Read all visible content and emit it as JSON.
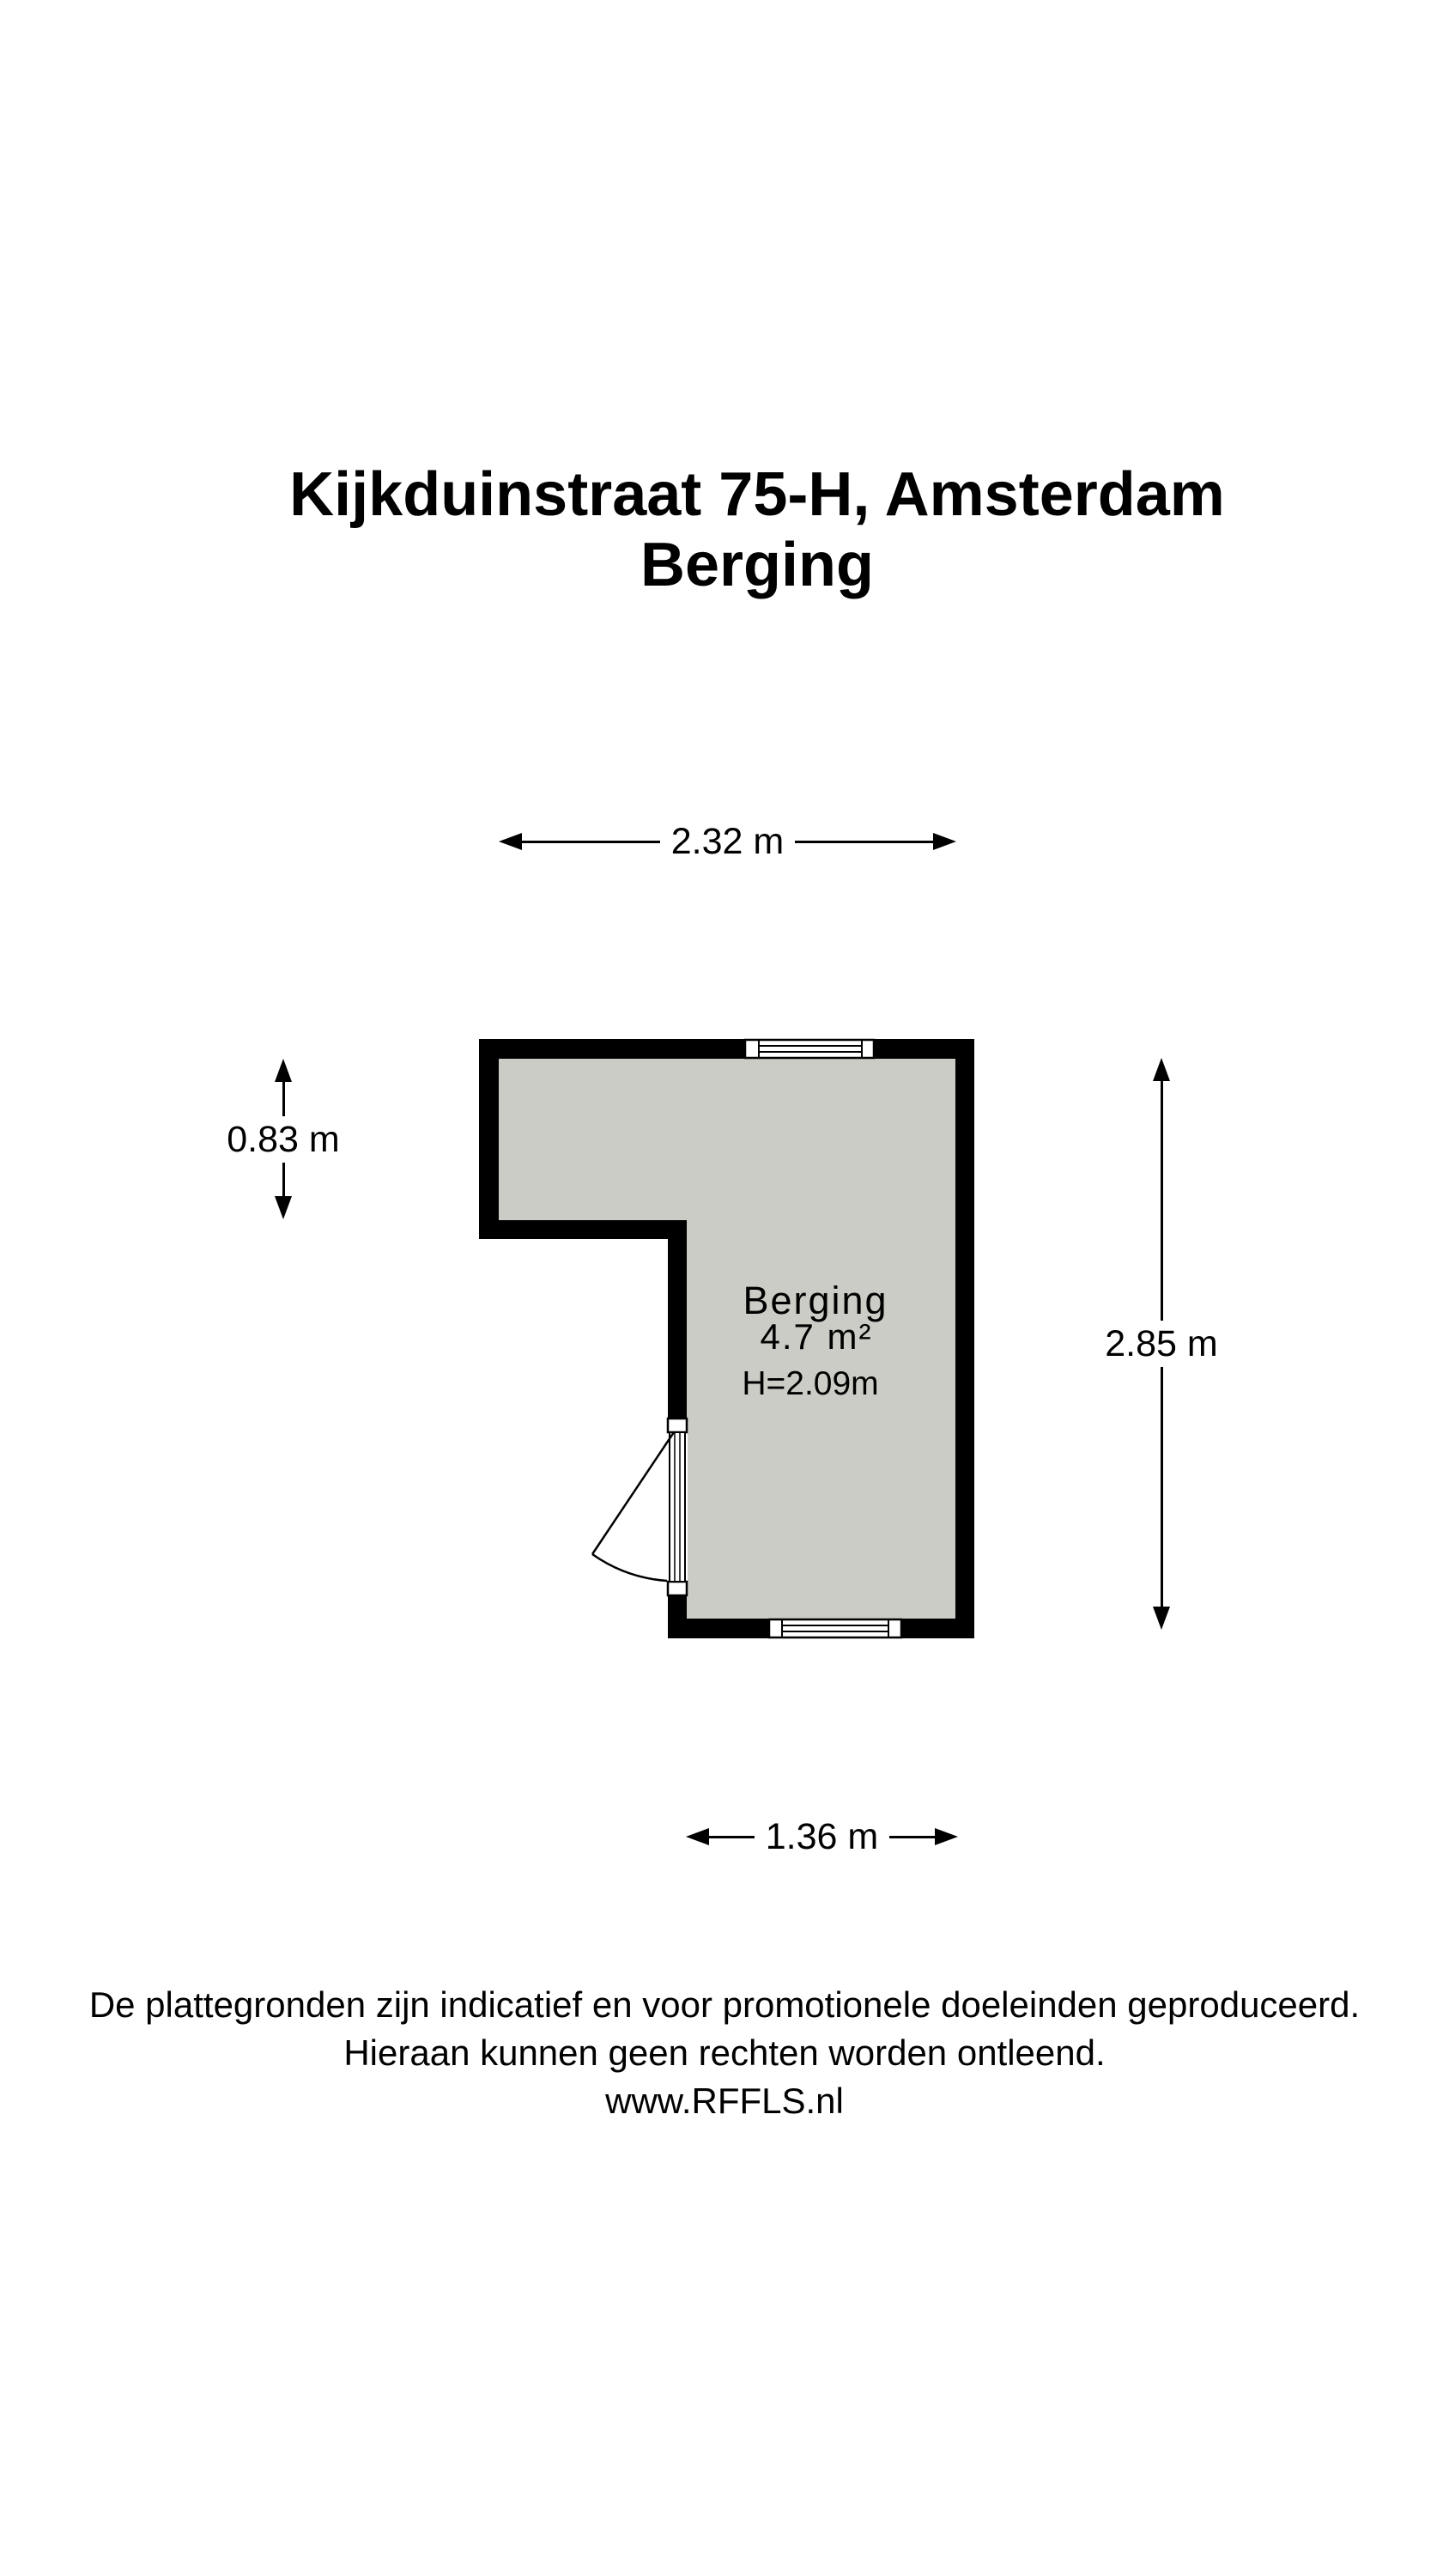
{
  "title": {
    "line1": "Kijkduinstraat 75-H, Amsterdam",
    "line2": "Berging"
  },
  "floorplan": {
    "room": {
      "name": "Berging",
      "area": "4.7 m²",
      "ceiling_height": "H=2.09m"
    },
    "dimensions": {
      "top": "2.32 m",
      "left": "0.83 m",
      "right": "2.85 m",
      "bottom": "1.36 m"
    }
  },
  "footer": {
    "line1": "De plattegronden zijn indicatief en voor promotionele doeleinden geproduceerd.",
    "line2": "Hieraan kunnen geen rechten worden ontleend.",
    "line3": "www.RFFLS.nl"
  },
  "colors": {
    "wall": "#000000",
    "floor": "#cbccc5",
    "background": "#ffffff",
    "text": "#000000"
  }
}
